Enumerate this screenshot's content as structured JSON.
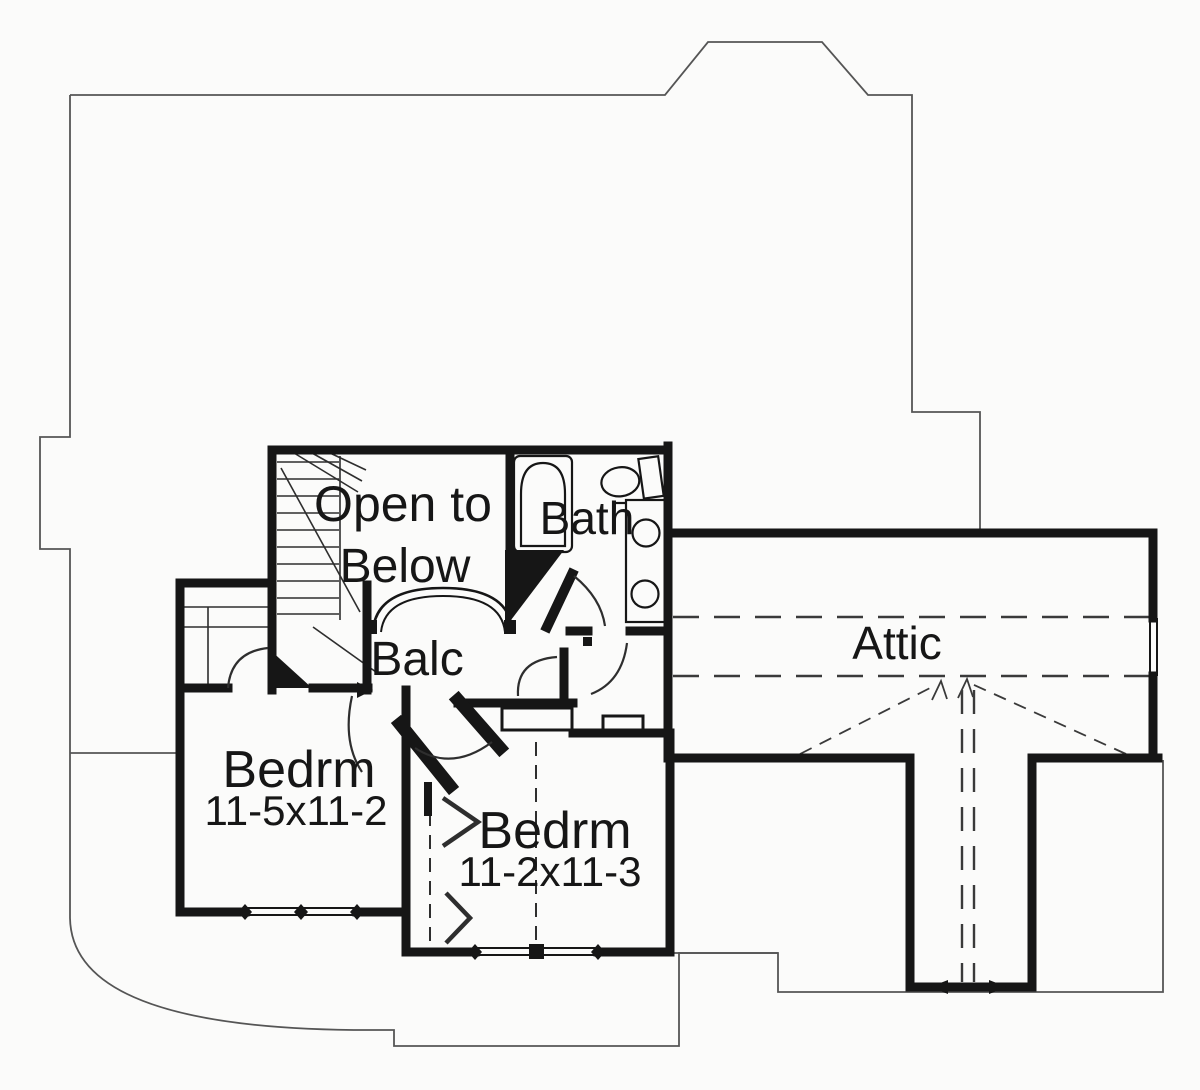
{
  "colors": {
    "ink": "#161616",
    "thin_line": "#2e2e2e",
    "roof_line": "#555555",
    "paper": "#fbfbfa"
  },
  "rooms": {
    "open_below": {
      "line1": "Open to",
      "line2": "Below"
    },
    "bath": {
      "label": "Bath"
    },
    "balcony": {
      "label": "Balc"
    },
    "attic": {
      "label": "Attic"
    },
    "bedroom1": {
      "label": "Bedrm",
      "dims": "11-5x11-2"
    },
    "bedroom2": {
      "label": "Bedrm",
      "dims": "11-2x11-3"
    }
  }
}
